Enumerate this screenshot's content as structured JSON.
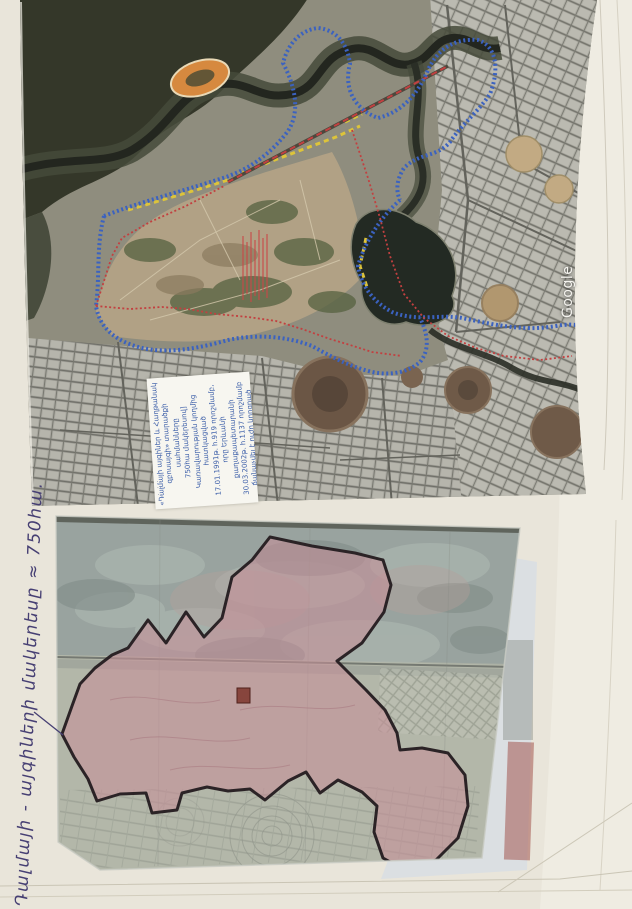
{
  "page": {
    "kind": "Photographed archive page with a satellite image and a cadastral map of the Dalma gardens area, Yerevan",
    "background_color": "#e9e5da"
  },
  "annotation": {
    "handwritten_text": "Դալմայի - այգիների մակերեսը ≈ 750հա.",
    "ink_color": "#463f73"
  },
  "satellite_photo": {
    "watermark": "Google",
    "label_box": {
      "text_color": "#3a5da8",
      "lines": [
        "«Դալմայի այգիներ և Հաղթանակ",
        "զբոսայգի» տարածքի սահմանները",
        "750հա մակերեսով]",
        "Կառավարության կողմից հատկացված",
        "17.01.1991թ. հ.919 որոշմամբ,",
        "որը Երևանի քաղաքապետարանի",
        "30.03.2002թ. հ.1137 որոշմամբ",
        "ճանաչվել է ուժը կորցրած"
      ]
    },
    "boundary_colors": {
      "city_boundary_blue": "#3b62c0",
      "road_marking_yellow": "#ddc43a",
      "parcel_boundary_red": "#c24040"
    }
  },
  "cadastral_map": {
    "zone_fill_pink": "#c78f98",
    "zone_outline_black": "#2b2326",
    "marker_square_red": "#7e352c"
  },
  "icons": {
    "legend_dots_row": "··"
  }
}
